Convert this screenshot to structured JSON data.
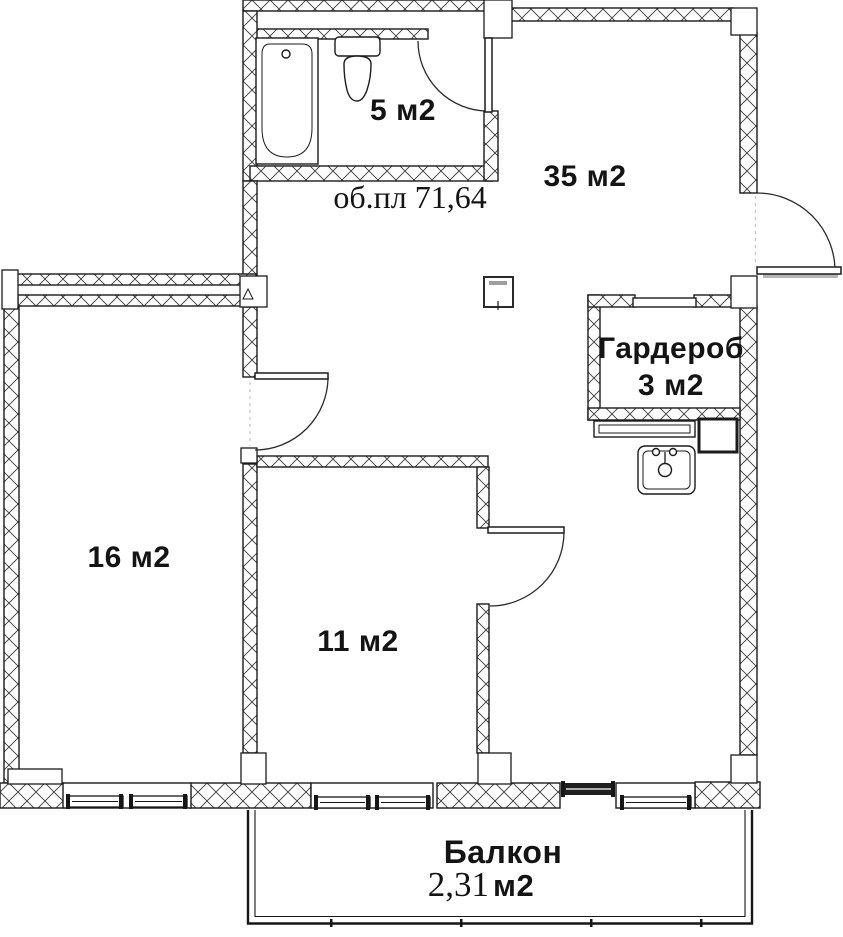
{
  "plan": {
    "colors": {
      "line": "#1b1b1b",
      "background": "#ffffff",
      "hatch": "#3a3a3a",
      "shading": "#b5b5b5"
    },
    "total_area_label": "об.пл 71,64",
    "rooms": {
      "bathroom": {
        "area": "5 м2"
      },
      "living": {
        "area": "35 м2"
      },
      "wardrobe": {
        "name": "Гардероб",
        "area": "3 м2"
      },
      "bedroom": {
        "area": "16 м2"
      },
      "small_room": {
        "area": "11 м2"
      },
      "balcony": {
        "name": "Балкон",
        "area_value": "2,31",
        "area_unit": "м2"
      }
    },
    "fixtures": {
      "bathtub": "bathtub-icon",
      "toilet": "toilet-icon",
      "sink": "sink-icon"
    }
  }
}
